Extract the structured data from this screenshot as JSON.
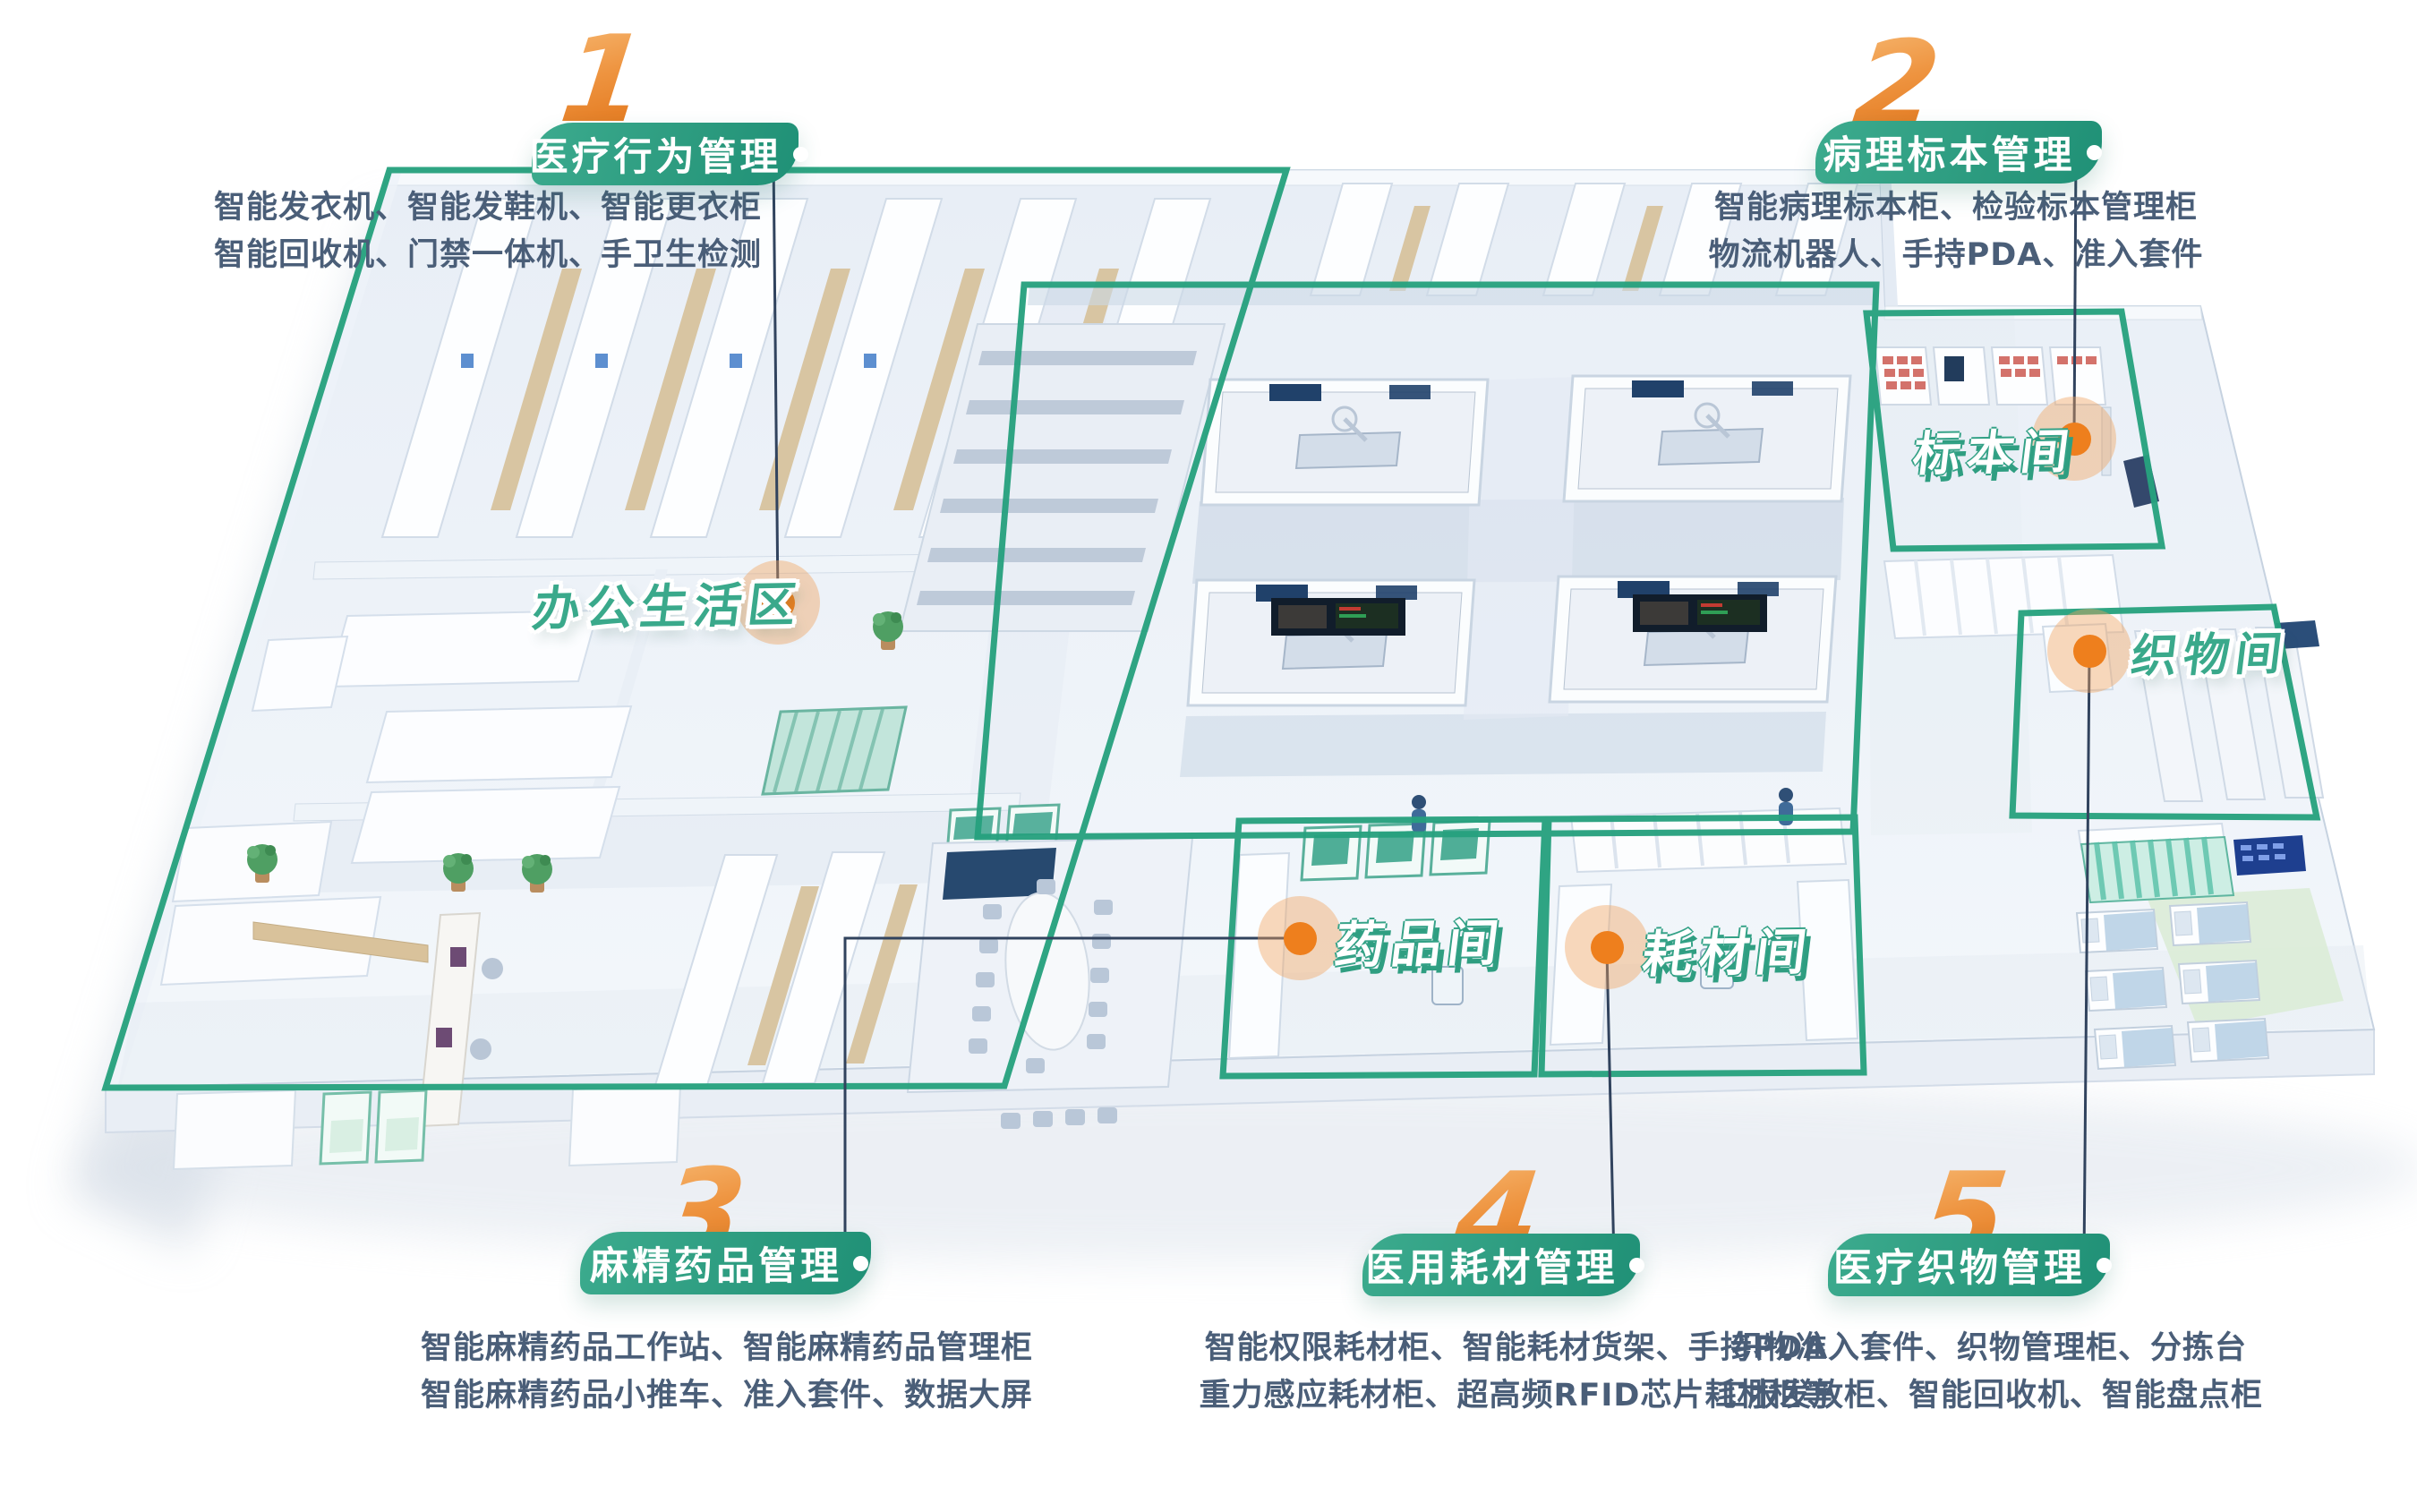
{
  "page": {
    "background_color": "#ffffff"
  },
  "palette": {
    "accent_green": "#2aa07f",
    "pill_gradient_start": "#3cab8e",
    "pill_gradient_end": "#1f9076",
    "numeral_orange_light": "#f5b168",
    "numeral_orange_dark": "#e2761b",
    "marker_orange": "#ee7f1d",
    "marker_halo": "rgba(240,163,92,0.42)",
    "connector_navy": "#31435e",
    "description_text": "#4a5e78",
    "room_label_green": "#3aa98b",
    "room_label_white": "#ffffff"
  },
  "callouts": [
    {
      "number": "1",
      "title": "医疗行为管理",
      "desc_line1": "智能发衣机、智能发鞋机、智能更衣柜",
      "desc_line2": "智能回收机、门禁一体机、手卫生检测"
    },
    {
      "number": "2",
      "title": "病理标本管理",
      "desc_line1": "智能病理标本柜、检验标本管理柜",
      "desc_line2": "物流机器人、手持PDA、准入套件"
    },
    {
      "number": "3",
      "title": "麻精药品管理",
      "desc_line1": "智能麻精药品工作站、智能麻精药品管理柜",
      "desc_line2": "智能麻精药品小推车、准入套件、数据大屏"
    },
    {
      "number": "4",
      "title": "医用耗材管理",
      "desc_line1": "智能权限耗材柜、智能耗材货架、手持PDA",
      "desc_line2": "重力感应耗材柜、超高频RFID芯片耗材柜等"
    },
    {
      "number": "5",
      "title": "医疗织物管理",
      "desc_line1": "织物准入套件、织物管理柜、分拣台",
      "desc_line2": "工服发放柜、智能回收机、智能盘点柜"
    }
  ],
  "room_labels": [
    {
      "text": "办公生活区",
      "style": "green"
    },
    {
      "text": "标本间",
      "style": "white"
    },
    {
      "text": "药品间",
      "style": "white"
    },
    {
      "text": "耗材间",
      "style": "white"
    },
    {
      "text": "织物间",
      "style": "green"
    }
  ]
}
